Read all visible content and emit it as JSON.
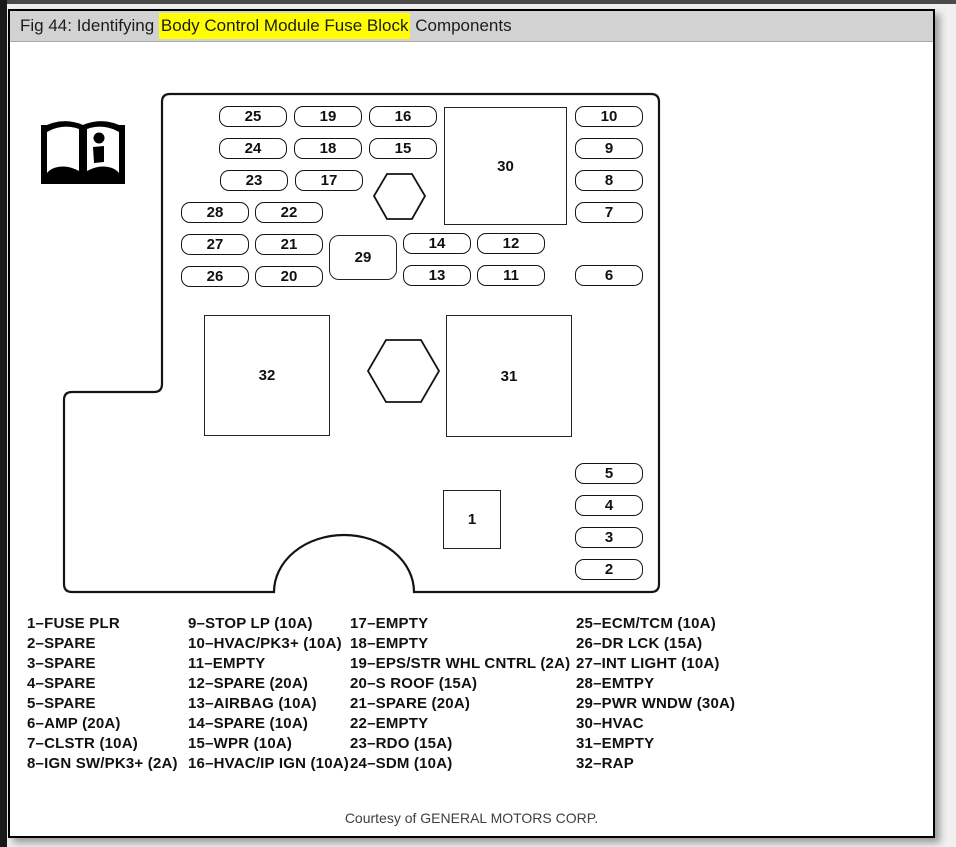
{
  "window": {
    "titlebar": {
      "prefix": "Fig 44: Identifying ",
      "highlight": "Body Control Module Fuse Block",
      "suffix": " Components",
      "highlight_color": "#ffff00",
      "bar_color": "#d2d2d2"
    },
    "courtesy": "Courtesy of GENERAL MOTORS CORP."
  },
  "colors": {
    "line": "#141414",
    "background": "#ffffff",
    "frame": "#4a4a4a"
  },
  "diagram": {
    "icon": "open-book-info-icon",
    "outline_path": "M 160 83 H 641 Q 649 83 649 91 V 573 Q 649 581 641 581 H 404 A 70 57 0 0 0 264 581 H 62 Q 54 581 54 573 V 389 Q 54 381 62 381 H 144 Q 152 381 152 373 V 91 Q 152 83 160 83 Z",
    "hexagons": [
      {
        "points": "364,185 377,163 402,163 415,185 402,208 377,208"
      },
      {
        "points": "358,360 376,329 411,329 429,360 411,391 376,391"
      }
    ],
    "fuses": [
      {
        "label": "25",
        "x": 209,
        "y": 95
      },
      {
        "label": "19",
        "x": 284,
        "y": 95
      },
      {
        "label": "16",
        "x": 359,
        "y": 95
      },
      {
        "label": "10",
        "x": 565,
        "y": 95
      },
      {
        "label": "24",
        "x": 209,
        "y": 127
      },
      {
        "label": "18",
        "x": 284,
        "y": 127
      },
      {
        "label": "15",
        "x": 359,
        "y": 127
      },
      {
        "label": "9",
        "x": 565,
        "y": 127
      },
      {
        "label": "23",
        "x": 210,
        "y": 159
      },
      {
        "label": "17",
        "x": 285,
        "y": 159
      },
      {
        "label": "8",
        "x": 565,
        "y": 159
      },
      {
        "label": "28",
        "x": 171,
        "y": 191
      },
      {
        "label": "22",
        "x": 245,
        "y": 191
      },
      {
        "label": "7",
        "x": 565,
        "y": 191
      },
      {
        "label": "27",
        "x": 171,
        "y": 223
      },
      {
        "label": "21",
        "x": 245,
        "y": 223
      },
      {
        "label": "14",
        "x": 393,
        "y": 222
      },
      {
        "label": "12",
        "x": 467,
        "y": 222
      },
      {
        "label": "26",
        "x": 171,
        "y": 255
      },
      {
        "label": "20",
        "x": 245,
        "y": 255
      },
      {
        "label": "13",
        "x": 393,
        "y": 254
      },
      {
        "label": "11",
        "x": 467,
        "y": 254
      },
      {
        "label": "6",
        "x": 565,
        "y": 254
      },
      {
        "label": "5",
        "x": 565,
        "y": 452
      },
      {
        "label": "4",
        "x": 565,
        "y": 484
      },
      {
        "label": "3",
        "x": 565,
        "y": 516
      },
      {
        "label": "2",
        "x": 565,
        "y": 548
      }
    ],
    "boxes": [
      {
        "label": "30",
        "x": 434,
        "y": 96,
        "w": 123,
        "h": 118,
        "rounded": false
      },
      {
        "label": "29",
        "x": 319,
        "y": 224,
        "w": 68,
        "h": 45,
        "rounded": true
      },
      {
        "label": "32",
        "x": 194,
        "y": 304,
        "w": 126,
        "h": 121,
        "rounded": false
      },
      {
        "label": "31",
        "x": 436,
        "y": 304,
        "w": 126,
        "h": 122,
        "rounded": false
      },
      {
        "label": "1",
        "x": 433,
        "y": 479,
        "w": 58,
        "h": 59,
        "rounded": false
      }
    ]
  },
  "legend": {
    "col_x": [
      17,
      178,
      340,
      566
    ],
    "columns": [
      [
        "1–FUSE PLR",
        "2–SPARE",
        "3–SPARE",
        "4–SPARE",
        "5–SPARE",
        "6–AMP (20A)",
        "7–CLSTR (10A)",
        "8–IGN SW/PK3+ (2A)"
      ],
      [
        "9–STOP LP (10A)",
        "10–HVAC/PK3+ (10A)",
        "11–EMPTY",
        "12–SPARE (20A)",
        "13–AIRBAG (10A)",
        "14–SPARE (10A)",
        "15–WPR (10A)",
        "16–HVAC/IP IGN (10A)"
      ],
      [
        "17–EMPTY",
        "18–EMPTY",
        "19–EPS/STR WHL CNTRL (2A)",
        "20–S ROOF (15A)",
        "21–SPARE (20A)",
        "22–EMPTY",
        "23–RDO (15A)",
        "24–SDM (10A)"
      ],
      [
        "25–ECM/TCM (10A)",
        "26–DR LCK (15A)",
        "27–INT LIGHT (10A)",
        "28–EMTPY",
        "29–PWR WNDW (30A)",
        "30–HVAC",
        "31–EMPTY",
        "32–RAP"
      ]
    ]
  }
}
